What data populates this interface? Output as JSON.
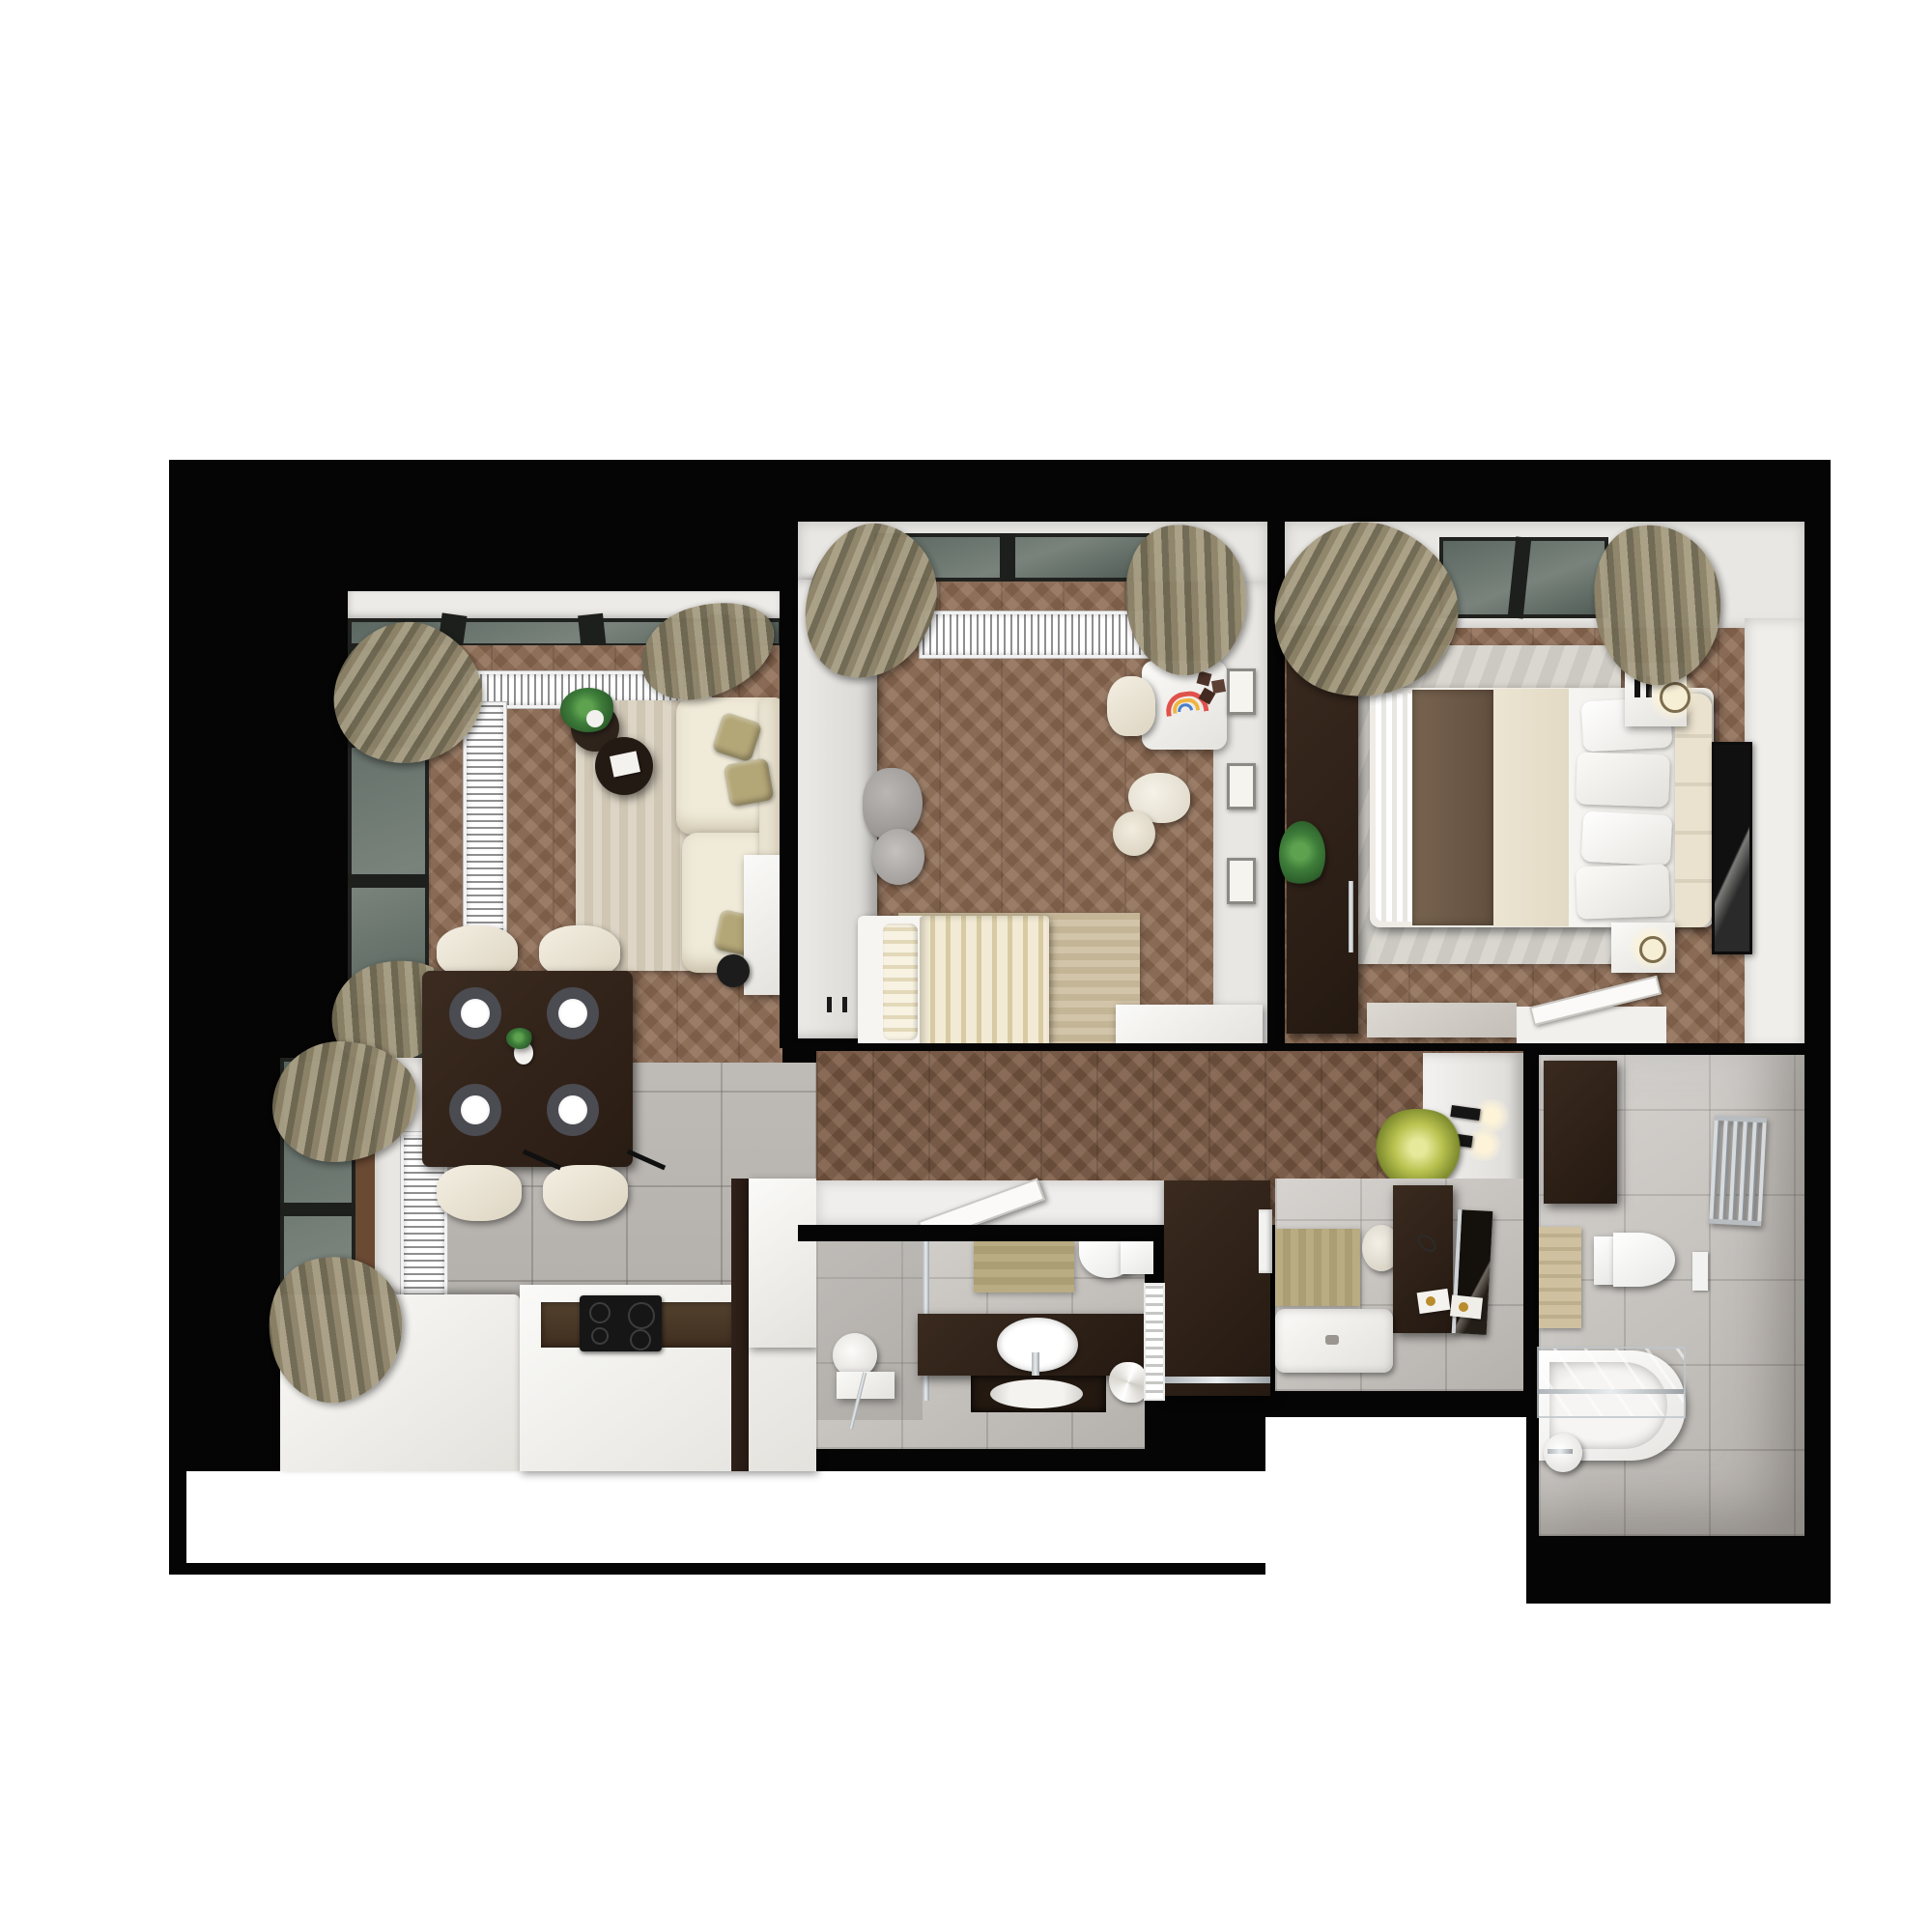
{
  "scene": {
    "type": "photorealistic top-down 3D floor plan render of a two-bedroom apartment",
    "view": "top-down",
    "page_background": "#ffffff",
    "no_visible_text": true
  },
  "palette": {
    "wall": "#050505",
    "floor-wood": "#8d6b53",
    "floor-wood-dark": "#7b5a44",
    "tile": "#b7b3ae",
    "tile-light": "#c9c5c0",
    "wall-white": "#e9e7e3",
    "sofa": "#f0ead9",
    "pillow": "#b3a677",
    "rug-living": "#dad2c2",
    "rug-kids": "#cfc1a5",
    "rug-master": "#d6d3cd",
    "espresso": "#2c1f17",
    "blanket-brown": "#6e5a48",
    "coverlet-cream": "#eae3cf",
    "duvet-white": "#f4f3f0",
    "headboard-cream": "#e7dfcb",
    "curtain-olive": "#8d8369",
    "beige-mat": "#b5a67e",
    "accent-plant": "#b9c24f",
    "cooktop": "#161616",
    "chrome": "#c9cdd0"
  },
  "rooms": [
    {
      "id": "living-room",
      "name": "Living room",
      "floor": "chevron wood",
      "items": [
        "balcony glazing",
        "corner windows",
        "olive curtains",
        "L-shaped radiator grille",
        "corner sofa",
        "olive pillows",
        "two round coffee tables",
        "potted plant",
        "magazine",
        "area rug",
        "white side table",
        "black vase"
      ]
    },
    {
      "id": "kids-bedroom",
      "name": "Kids bedroom",
      "floor": "chevron wood",
      "items": [
        "window",
        "olive curtains",
        "radiator grille",
        "white wardrobe",
        "single bed with striped duvet",
        "pillow",
        "area rug",
        "plush elephant",
        "plush sheep",
        "kids desk with rainbow drawing",
        "toy blocks",
        "white chair",
        "three wall frames",
        "low white dresser"
      ]
    },
    {
      "id": "master-bedroom",
      "name": "Master bedroom",
      "floor": "chevron wood",
      "items": [
        "window",
        "olive curtains",
        "radiator grille",
        "dark wardrobe",
        "double bed",
        "brown blanket",
        "cream coverlet",
        "white duvet",
        "four pillows",
        "upholstered headboard",
        "two nightstands",
        "two lamps",
        "tall black artwork",
        "greige dresser",
        "open door",
        "potted plant",
        "area rug"
      ]
    },
    {
      "id": "kitchen-dining",
      "name": "Kitchen and dining",
      "floor": "gray tile",
      "items": [
        "corner windows",
        "olive curtains",
        "two radiators",
        "dark dining table",
        "four place settings",
        "white vase",
        "four cream chairs",
        "L-shaped white counter",
        "dark cabinet inset",
        "induction cooktop",
        "tall cabinet"
      ]
    },
    {
      "id": "hallway",
      "name": "Hallway",
      "floor": "chevron wood",
      "items": [
        "entry wall",
        "two black sconces",
        "accent plant",
        "dark wardrobe column",
        "washing machine",
        "open bathroom door"
      ]
    },
    {
      "id": "bathroom-main",
      "name": "Bathroom with shower",
      "floor": "gray tile",
      "items": [
        "glass shower partition",
        "round stool",
        "hand shower",
        "dark vanity",
        "oval countertop basin",
        "mirror niche",
        "wall-hung toilet",
        "beige mat",
        "folded towel",
        "white towel radiator"
      ]
    },
    {
      "id": "bathroom-vanity",
      "name": "Guest bathroom / laundry",
      "floor": "gray tile",
      "items": [
        "dark makeup vanity",
        "leaning mirror",
        "round stool",
        "beige mat",
        "shower tray",
        "makeup trays",
        "washing machine front"
      ]
    },
    {
      "id": "bathroom-bath",
      "name": "Main bathroom with bathtub",
      "floor": "gray tile",
      "items": [
        "dark wall panel",
        "chrome towel radiator",
        "wall-hung toilet",
        "flush plate",
        "beige towels",
        "bathtub",
        "glass bath screen",
        "toilet paper holder"
      ]
    }
  ]
}
